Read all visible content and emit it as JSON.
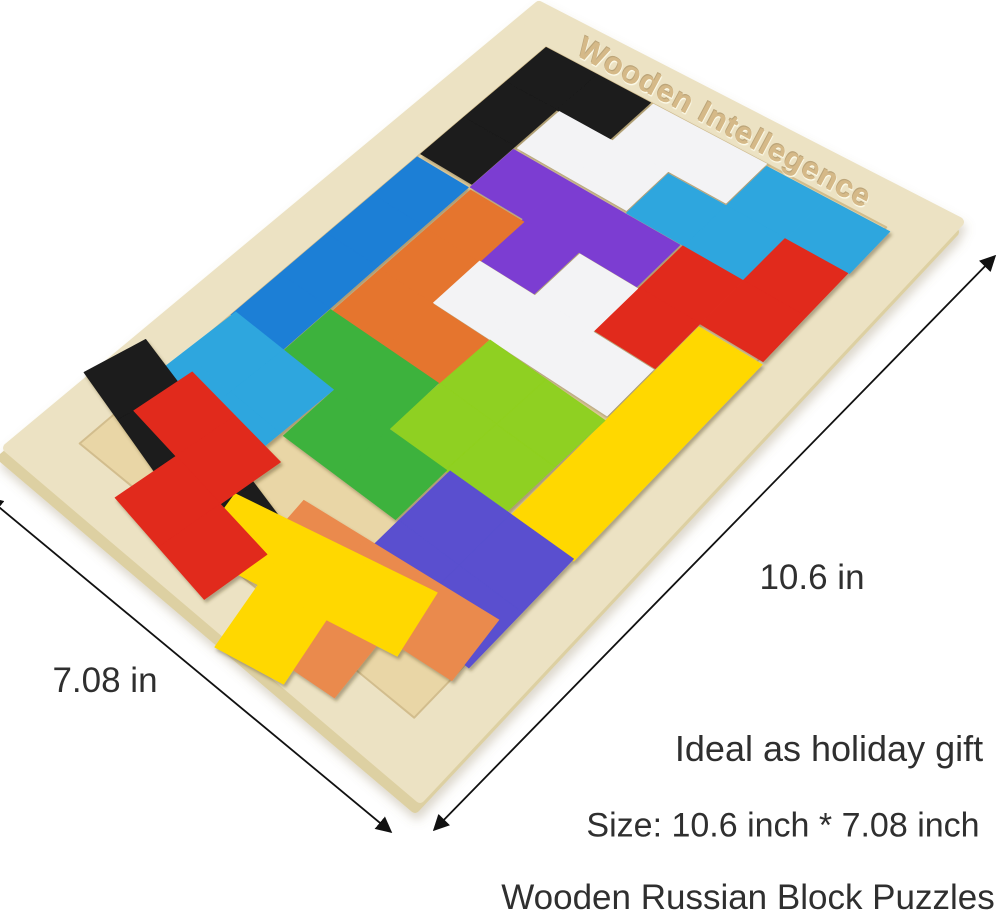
{
  "product": {
    "engraving": "Wooden Intellegence",
    "captions": {
      "gift": "Ideal as holiday gift",
      "size": "Size: 10.6 inch * 7.08 inch",
      "title": "Wooden Russian Block Puzzles"
    }
  },
  "dimensions": {
    "length": {
      "label": "10.6 in",
      "x1": 995,
      "y1": 256,
      "x2": 434,
      "y2": 830,
      "label_x": 812,
      "label_y": 578
    },
    "width": {
      "label": "7.08 in",
      "x1": -12,
      "y1": 498,
      "x2": 391,
      "y2": 832,
      "label_x": 105,
      "label_y": 681
    }
  },
  "board": {
    "corners": [
      [
        539,
        6
      ],
      [
        959,
        222
      ],
      [
        420,
        798
      ],
      [
        8,
        448
      ]
    ],
    "grid": {
      "cols": 6,
      "rows": 10
    },
    "rim": 0.7,
    "side_offset": [
      -5,
      10
    ],
    "colors": {
      "side": "#ddd0a2",
      "rim": "#ece2c3",
      "field": "#e9d6a6",
      "field_edge": "#d2bd8d",
      "arrow": "#111111"
    }
  },
  "palette": {
    "red": "#e12a1c",
    "orange": "#e5752f",
    "orange2": "#ea8a4e",
    "yellow": "#ffd800",
    "lime": "#8fd020",
    "green": "#3eb23e",
    "sky": "#2ea6de",
    "blue": "#1c7fd6",
    "purple": "#7c3ed2",
    "indigo": "#5a50cf",
    "black": "#1b1b1b",
    "white": "#f3f3f5"
  },
  "pieces": [
    {
      "name": "black-j-piece",
      "color": "black",
      "cells": [
        [
          0,
          0
        ],
        [
          0,
          1
        ],
        [
          0,
          2
        ],
        [
          1,
          0
        ]
      ],
      "dx": 0,
      "dy": 0,
      "rot": 0
    },
    {
      "name": "white-s-piece",
      "color": "white",
      "cells": [
        [
          2,
          0
        ],
        [
          3,
          0
        ],
        [
          1,
          1
        ],
        [
          2,
          1
        ]
      ],
      "dx": 0.05,
      "dy": 0,
      "rot": 0
    },
    {
      "name": "sky-s-piece",
      "color": "sky",
      "cells": [
        [
          4,
          0
        ],
        [
          5,
          0
        ],
        [
          3,
          1
        ],
        [
          4,
          1
        ]
      ],
      "dx": 0.08,
      "dy": 0.04,
      "rot": 0
    },
    {
      "name": "red-s-piece",
      "color": "red",
      "cells": [
        [
          5,
          1
        ],
        [
          5,
          2
        ],
        [
          4,
          2
        ],
        [
          4,
          3
        ]
      ],
      "dx": 0.06,
      "dy": 0.05,
      "rot": 0
    },
    {
      "name": "purple-t-piece",
      "color": "purple",
      "cells": [
        [
          1,
          2
        ],
        [
          2,
          2
        ],
        [
          3,
          2
        ],
        [
          2,
          3
        ]
      ],
      "dx": 0.02,
      "dy": 0.06,
      "rot": 0
    },
    {
      "name": "blue-i-piece",
      "color": "blue",
      "cells": [
        [
          0,
          3
        ],
        [
          0,
          4
        ],
        [
          0,
          5
        ],
        [
          0,
          6
        ]
      ],
      "dx": 0,
      "dy": 0.08,
      "rot": 0
    },
    {
      "name": "orange-j-piece",
      "color": "orange",
      "cells": [
        [
          1,
          3
        ],
        [
          1,
          4
        ],
        [
          1,
          5
        ],
        [
          2,
          5
        ]
      ],
      "dx": 0.06,
      "dy": 0.1,
      "rot": 0
    },
    {
      "name": "white-t-piece",
      "color": "white",
      "cells": [
        [
          3,
          3
        ],
        [
          2,
          4
        ],
        [
          3,
          4
        ],
        [
          4,
          4
        ]
      ],
      "dx": 0.05,
      "dy": 0.08,
      "rot": 0
    },
    {
      "name": "yellow-i-piece",
      "color": "yellow",
      "cells": [
        [
          5,
          3
        ],
        [
          5,
          4
        ],
        [
          5,
          5
        ],
        [
          5,
          6
        ]
      ],
      "dx": 0.08,
      "dy": 0.1,
      "rot": 0
    },
    {
      "name": "lime-o-piece",
      "color": "lime",
      "cells": [
        [
          3,
          5
        ],
        [
          4,
          5
        ],
        [
          3,
          6
        ],
        [
          4,
          6
        ]
      ],
      "dx": 0.04,
      "dy": 0.12,
      "rot": 2
    },
    {
      "name": "green-s-piece",
      "color": "green",
      "cells": [
        [
          1,
          6
        ],
        [
          2,
          6
        ],
        [
          2,
          7
        ],
        [
          3,
          7
        ]
      ],
      "dx": 0.02,
      "dy": 0.1,
      "rot": 0
    },
    {
      "name": "sky-o-piece",
      "color": "sky",
      "cells": [
        [
          0,
          7
        ],
        [
          1,
          7
        ],
        [
          0,
          8
        ],
        [
          1,
          8
        ]
      ],
      "dx": -0.04,
      "dy": 0.05,
      "rot": 3
    },
    {
      "name": "indigo-o-piece",
      "color": "indigo",
      "cells": [
        [
          4,
          7
        ],
        [
          5,
          7
        ],
        [
          4,
          8
        ],
        [
          5,
          8
        ]
      ],
      "dx": 0.06,
      "dy": 0.08,
      "rot": 0
    },
    {
      "name": "orange-t-piece",
      "color": "orange2",
      "cells": [
        [
          3,
          9
        ],
        [
          4,
          9
        ],
        [
          5,
          9
        ],
        [
          4,
          10
        ]
      ],
      "dx": 0,
      "dy": -0.5,
      "rot": -6
    },
    {
      "name": "black-i-piece",
      "color": "black",
      "cells": [
        [
          0,
          9
        ],
        [
          1,
          9
        ],
        [
          2,
          9
        ],
        [
          3,
          9
        ]
      ],
      "dx": -0.8,
      "dy": -0.35,
      "rot": 14
    },
    {
      "name": "yellow-t-piece",
      "color": "yellow",
      "cells": [
        [
          2,
          10
        ],
        [
          3,
          10
        ],
        [
          4,
          10
        ],
        [
          3,
          11
        ]
      ],
      "dx": 0.3,
      "dy": -1.15,
      "rot": -12
    },
    {
      "name": "red-s2-piece",
      "color": "red",
      "cells": [
        [
          0,
          10
        ],
        [
          1,
          10
        ],
        [
          1,
          11
        ],
        [
          2,
          11
        ]
      ],
      "dx": 0.15,
      "dy": -1.65,
      "rot": 8
    }
  ]
}
